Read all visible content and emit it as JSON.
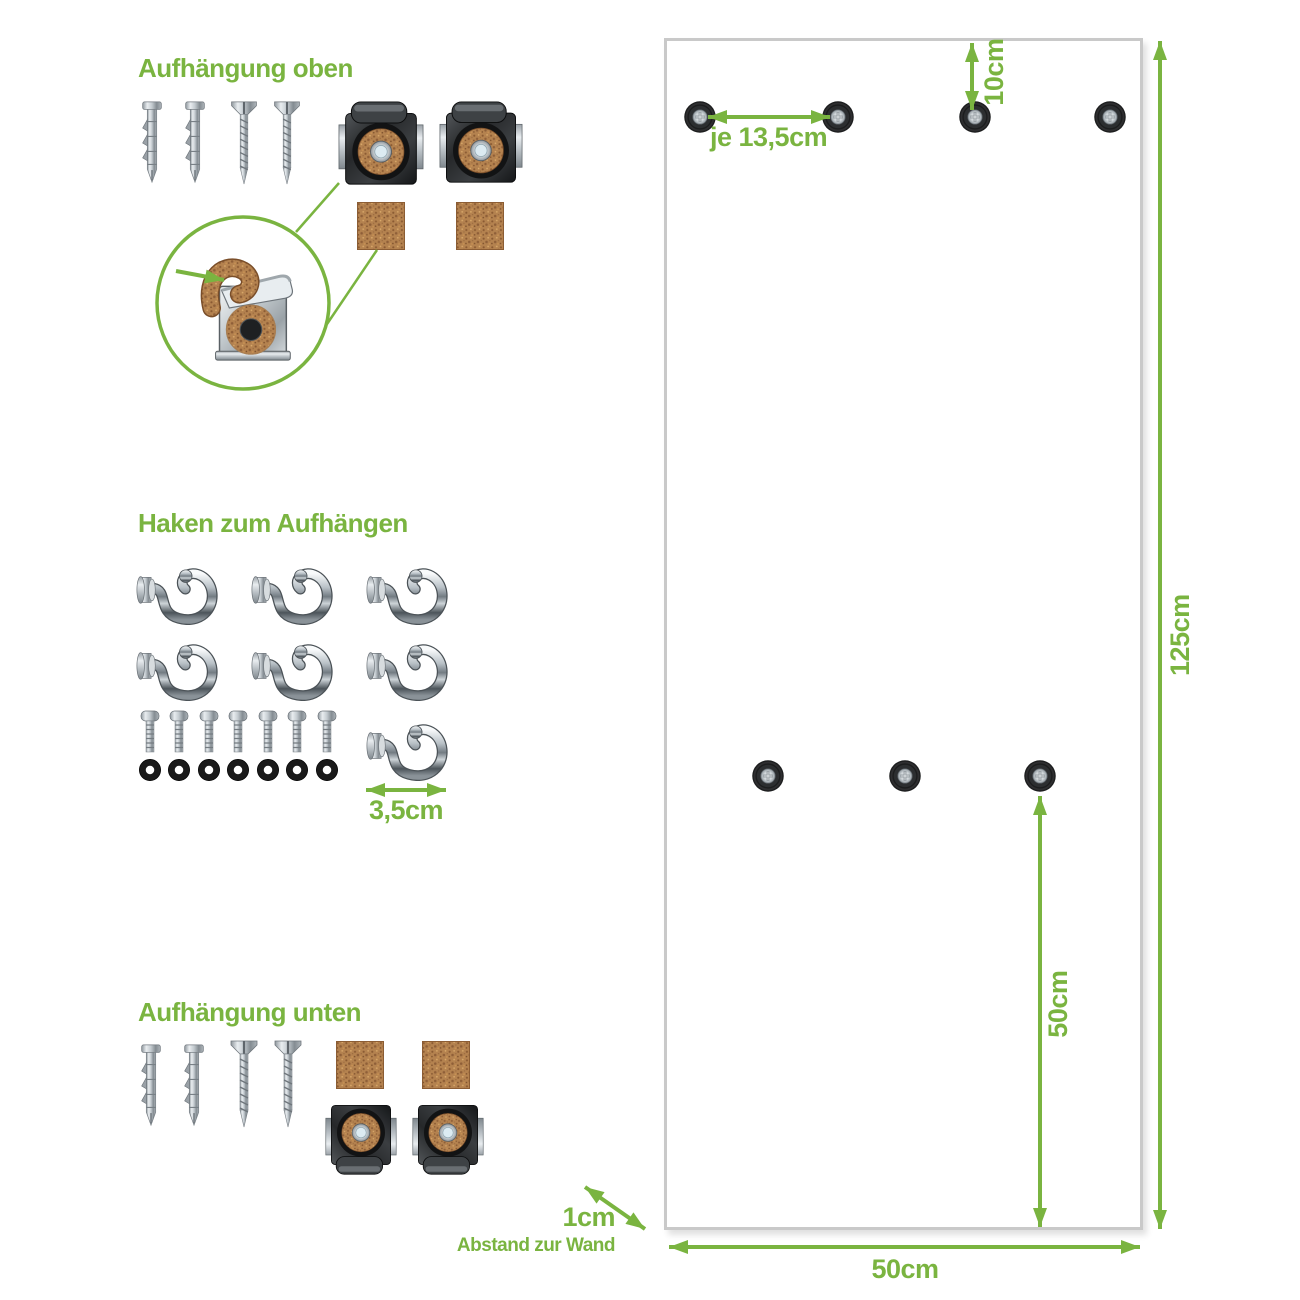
{
  "document_language": "de",
  "colors": {
    "accent_green": "#7ab440",
    "panel_border": "#c9c9c9",
    "hole_black": "#1c1d1e",
    "cork_brown": "#b4824f",
    "metal_silver": "#c3cacf"
  },
  "sections": {
    "top_mount": {
      "title": "Aufhängung oben",
      "wall_plug_count": 2,
      "screw_count": 2,
      "clip_count": 2,
      "cork_pad_count": 2,
      "has_magnifier_detail": true
    },
    "hooks": {
      "title": "Haken zum Aufhängen",
      "hook_count": 7,
      "bolt_count": 7,
      "washer_count": 7,
      "hook_size_label": "3,5cm"
    },
    "bottom_mount": {
      "title": "Aufhängung unten",
      "wall_plug_count": 2,
      "screw_count": 2,
      "clip_count": 2,
      "cork_pad_count": 2
    }
  },
  "panel": {
    "top_hole_count": 4,
    "middle_hole_count": 3,
    "dims": {
      "hole_spacing": "je 13,5cm",
      "top_offset": "10cm",
      "height": "125cm",
      "bottom_hole_offset": "50cm",
      "width": "50cm",
      "wall_distance": "1cm",
      "wall_distance_caption": "Abstand zur Wand"
    }
  }
}
